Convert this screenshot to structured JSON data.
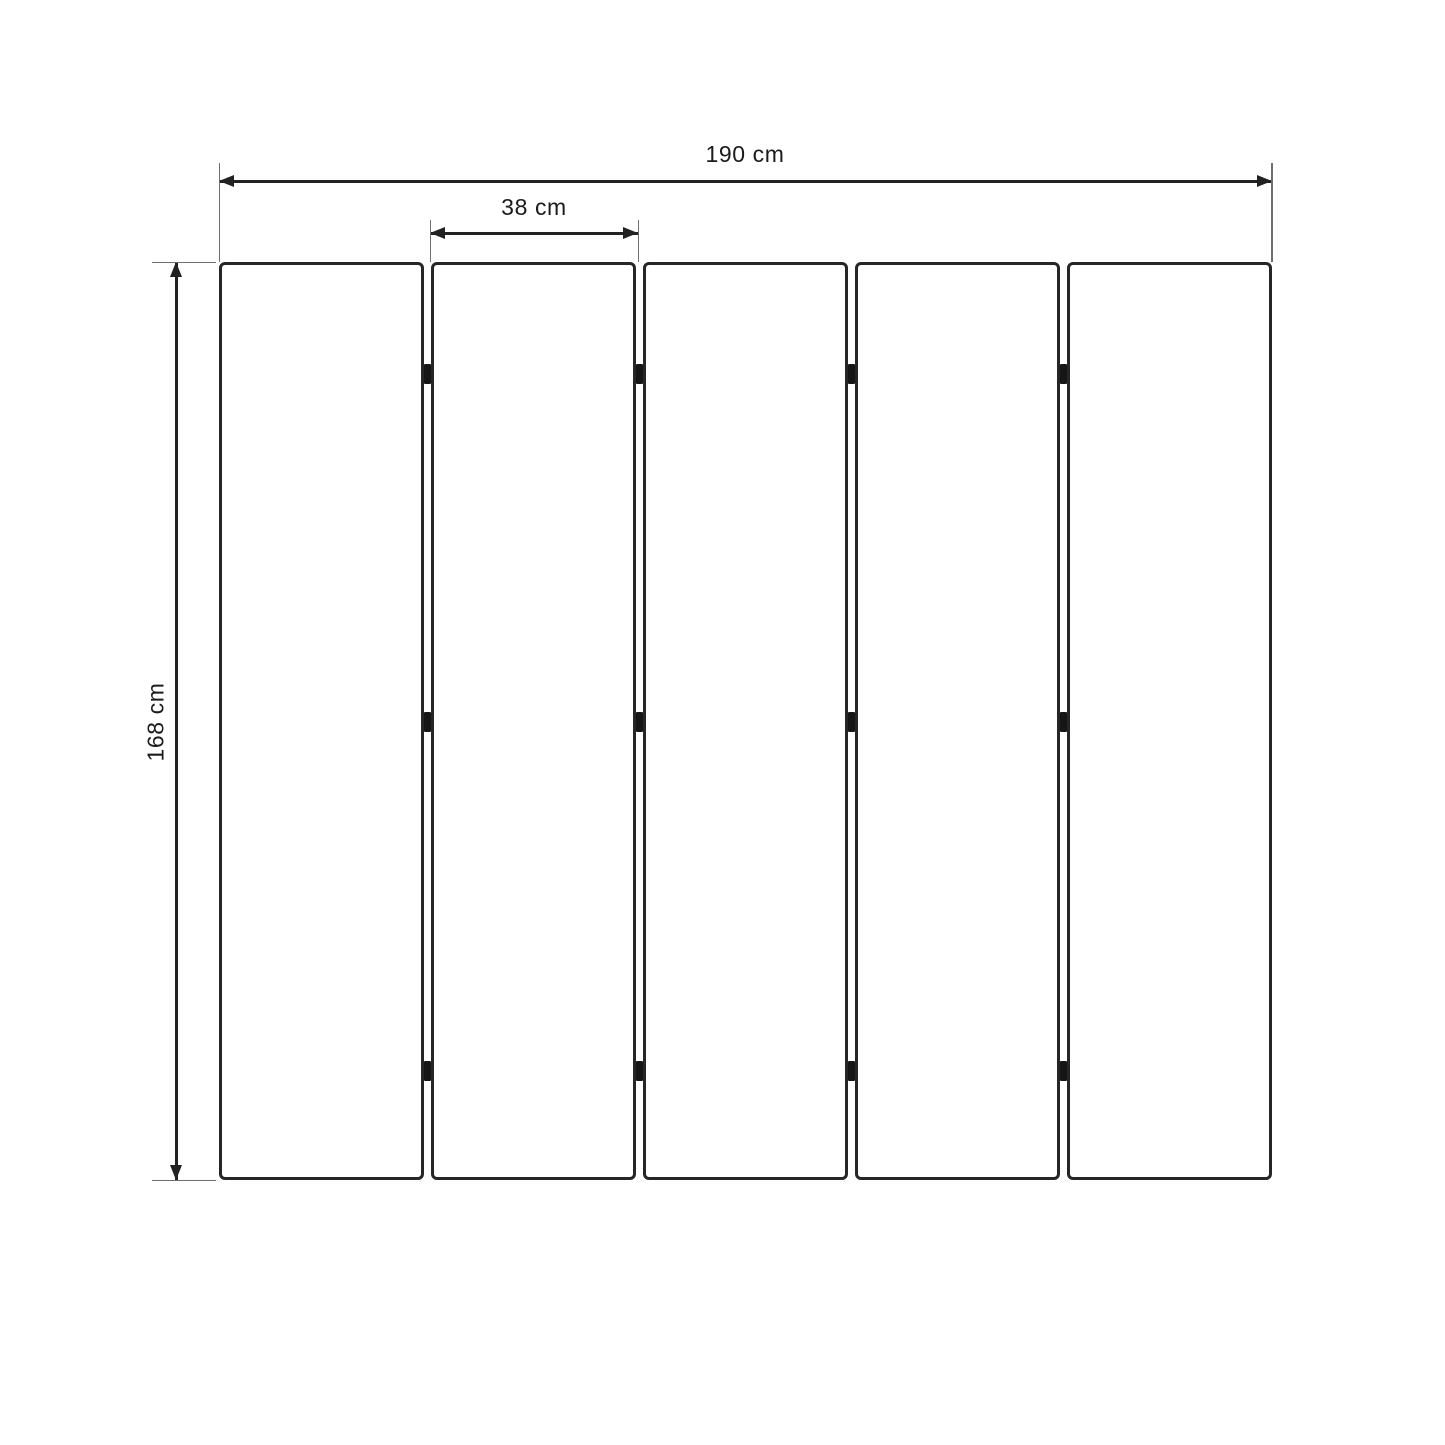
{
  "diagram": {
    "type": "product-dimension-diagram",
    "subject": "five-panel folding screen front view",
    "panel_count": 5,
    "dimensions": {
      "total_width": "190 cm",
      "panel_width": "38 cm",
      "height": "168 cm"
    },
    "colors": {
      "background": "#ffffff",
      "panel_outline": "#262626",
      "dimension_line": "#222222",
      "extension_line": "#6e6e6e",
      "hinge": "#161616",
      "label_text": "#1b1b1b"
    }
  }
}
